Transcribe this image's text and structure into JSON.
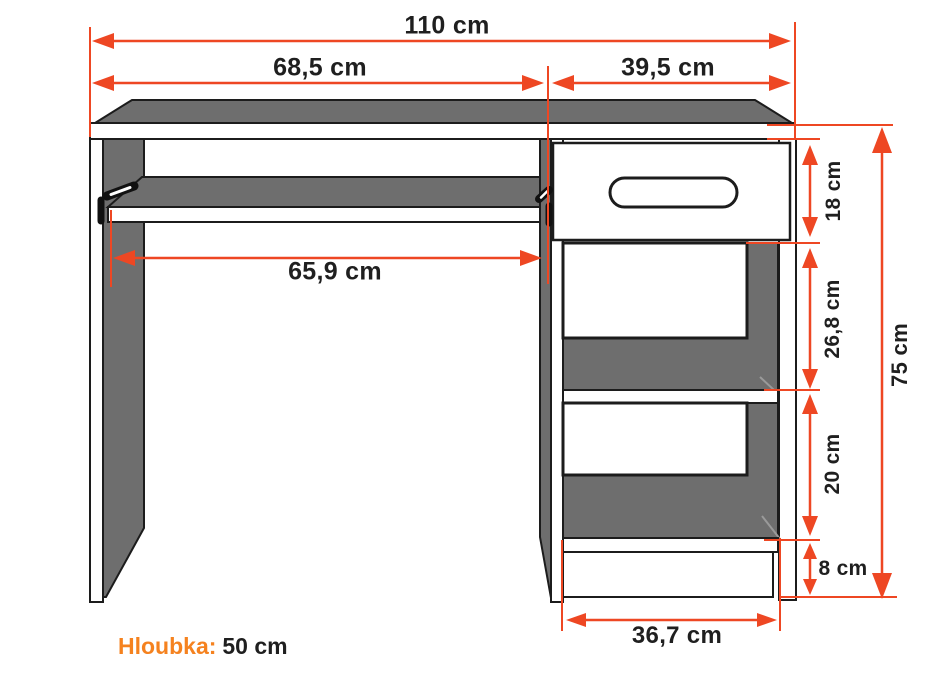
{
  "diagram": {
    "type": "furniture-technical-drawing",
    "subject": "computer-desk-front-view",
    "dimensions": {
      "total_width": "110 cm",
      "left_section": "68,5 cm",
      "right_section": "39,5 cm",
      "keyboard_tray": "65,9 cm",
      "drawer_height": "18 cm",
      "upper_shelf": "26,8 cm",
      "lower_shelf": "20 cm",
      "plinth": "8 cm",
      "total_height": "75 cm",
      "cabinet_width": "36,7 cm"
    },
    "depth": {
      "label": "Hloubka:",
      "value": "50 cm"
    },
    "colors": {
      "dimension_red": "#ee4723",
      "accent_orange": "#f5821f",
      "panel_gray": "#6e6e6e",
      "outline": "#1c1c1c",
      "label_text": "#1f1f1f",
      "background": "#ffffff"
    }
  }
}
